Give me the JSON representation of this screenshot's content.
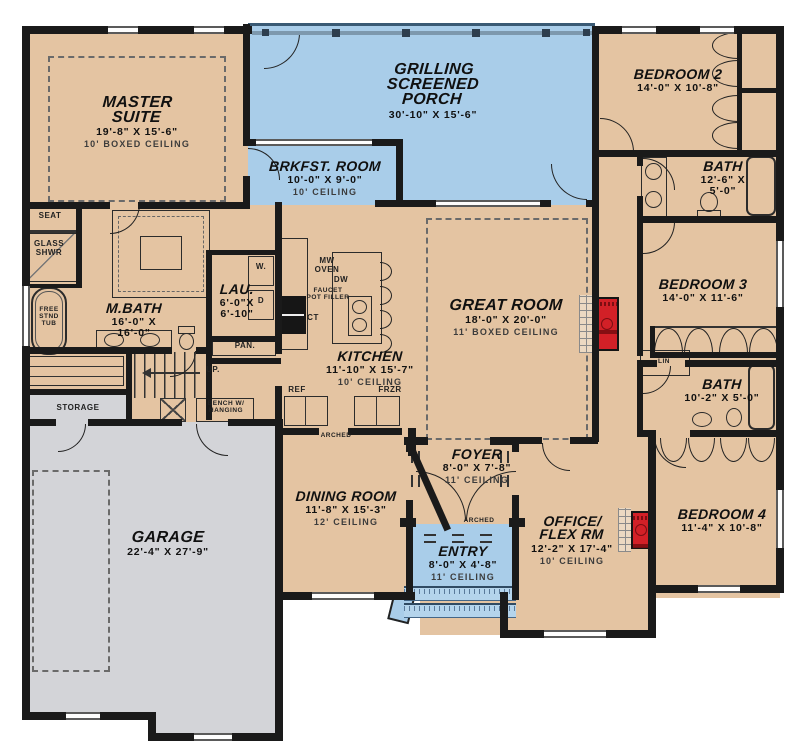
{
  "colors": {
    "room_tan": "#e4c4a2",
    "porch_blue": "#a9cde9",
    "garage_gray": "#d3d4d8",
    "wall_black": "#1a1a1a",
    "fireplace_red": "#d22027"
  },
  "rooms": {
    "master": {
      "name": "MASTER\nSUITE",
      "dim": "19'-8\" X 15'-6\"",
      "ceiling": "10' BOXED CEILING"
    },
    "porch": {
      "name": "GRILLING\nSCREENED\nPORCH",
      "dim": "30'-10\" X 15'-6\""
    },
    "brkfst": {
      "name": "BRKFST. ROOM",
      "dim": "10'-0\" X 9'-0\"",
      "ceiling": "10' CEILING"
    },
    "bedroom2": {
      "name": "BEDROOM 2",
      "dim": "14'-0\" X 10'-8\""
    },
    "bath1": {
      "name": "BATH",
      "dim": "12'-6\" X\n5'-0\""
    },
    "mbath": {
      "name": "M.BATH",
      "dim": "16'-0\" X\n16'-0\""
    },
    "lau": {
      "name": "LAU.",
      "dim": "6'-0\"X\n6'-10\""
    },
    "kitchen": {
      "name": "KITCHEN",
      "dim": "11'-10\" X 15'-7\"",
      "ceiling": "10' CEILING"
    },
    "greatroom": {
      "name": "GREAT ROOM",
      "dim": "18'-0\" X 20'-0\"",
      "ceiling": "11' BOXED CEILING"
    },
    "bedroom3": {
      "name": "BEDROOM 3",
      "dim": "14'-0\" X 11'-6\""
    },
    "bath2": {
      "name": "BATH",
      "dim": "10'-2\" X 5'-0\""
    },
    "foyer": {
      "name": "FOYER",
      "dim": "8'-0\" X 7'-8\"",
      "ceiling": "11' CEILING"
    },
    "dining": {
      "name": "DINING ROOM",
      "dim": "11'-8\" X 15'-3\"",
      "ceiling": "12' CEILING"
    },
    "entry": {
      "name": "ENTRY",
      "dim": "8'-0\" X 4'-8\"",
      "ceiling": "11' CEILING"
    },
    "office": {
      "name": "OFFICE/\nFLEX RM",
      "dim": "12'-2\" X 17'-4\"",
      "ceiling": "10' CEILING"
    },
    "bedroom4": {
      "name": "BEDROOM 4",
      "dim": "11'-4\" X 10'-8\""
    },
    "garage": {
      "name": "GARAGE",
      "dim": "22'-4\" X 27'-9\""
    }
  },
  "labels": {
    "seat": "SEAT",
    "glass_shwr": "GLASS\nSHWR",
    "tub": "FREE\nSTND\nTUB",
    "w": "W.",
    "d": "D",
    "pan": "PAN.",
    "up": "UP.",
    "storage": "STORAGE",
    "bench": "BENCH W/\nHANGING",
    "lin": "LIN",
    "mw_oven": "MW\nOVEN",
    "dw": "DW",
    "faucet": "FAUCET\nPOT FILLER",
    "ct": "CT",
    "ref": "REF",
    "frzr": "FRZR",
    "arched": "ARCHED"
  }
}
